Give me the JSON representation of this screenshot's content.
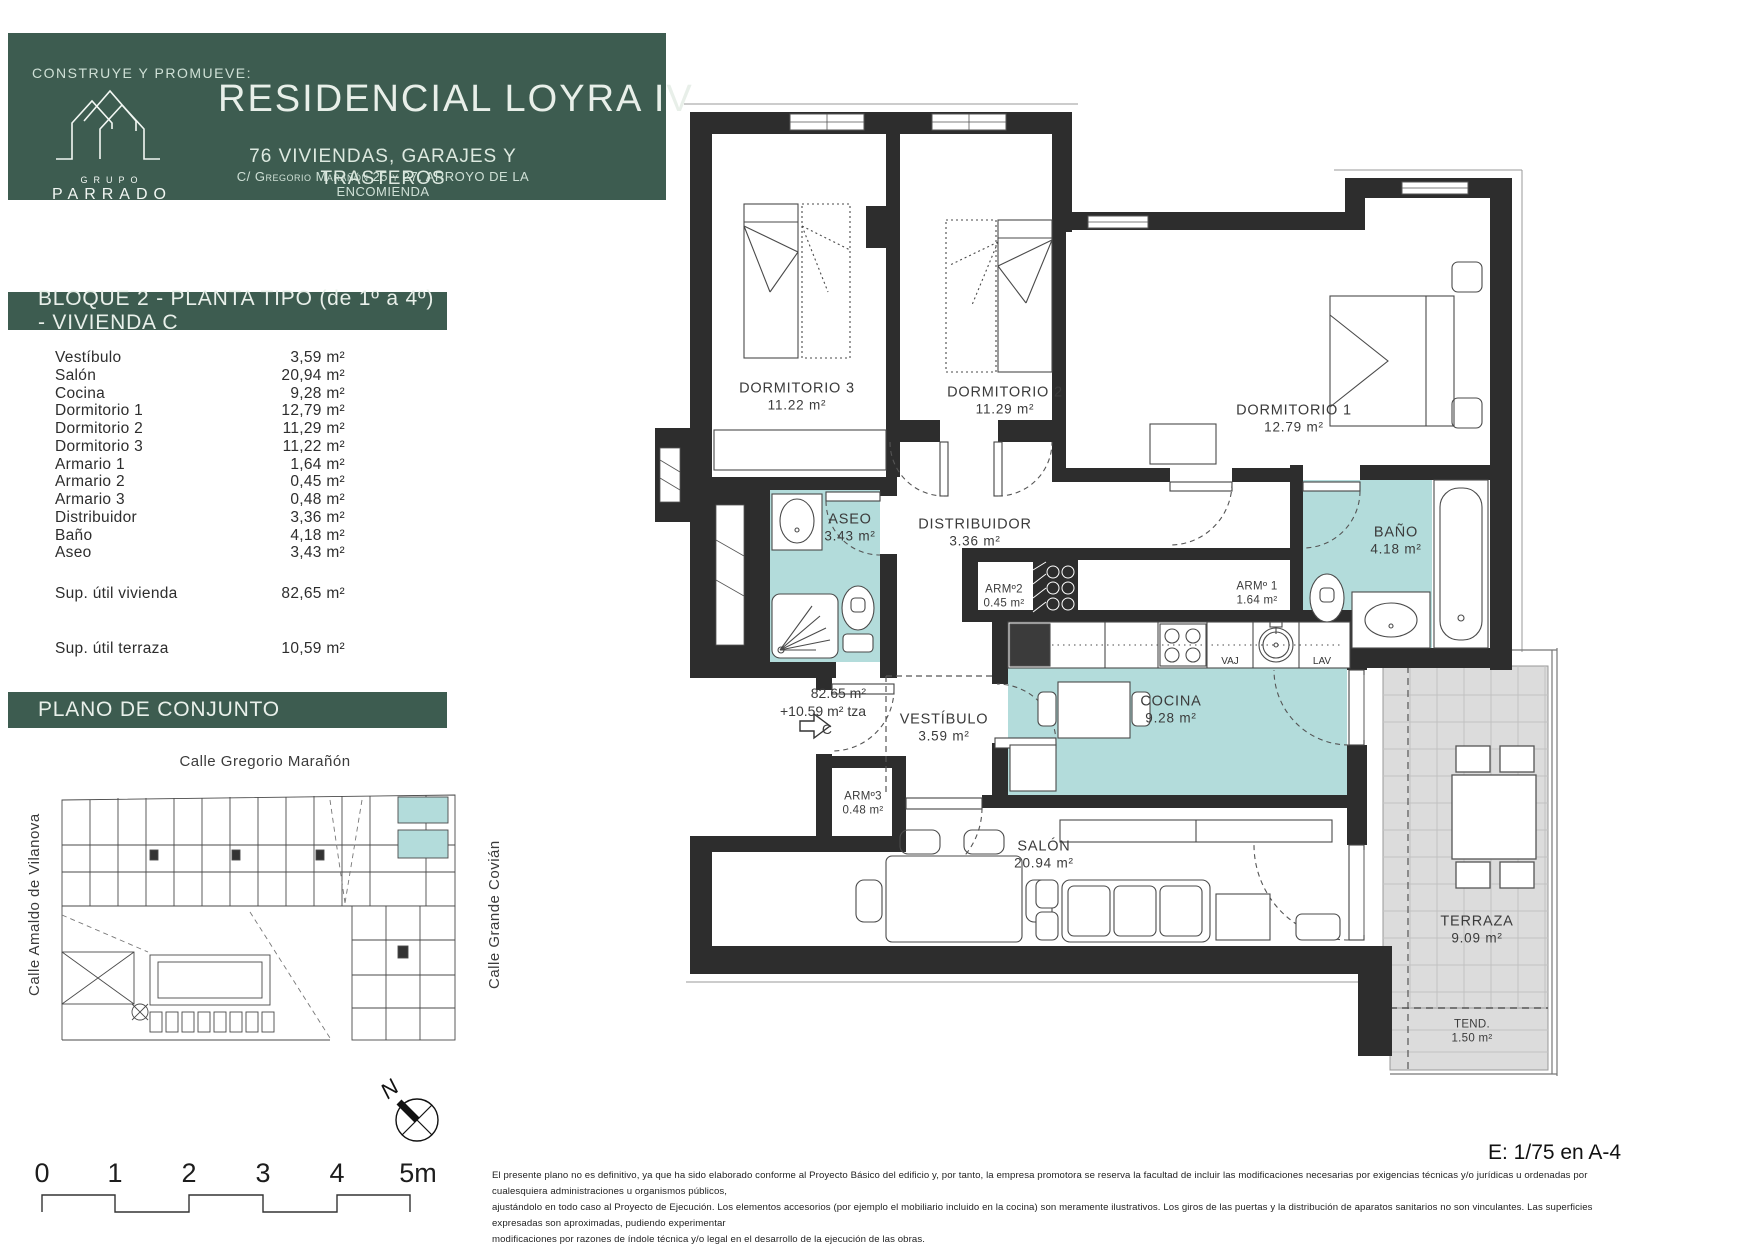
{
  "header": {
    "tagline": "CONSTRUYE Y PROMUEVE:",
    "logo": {
      "top": "GRUPO",
      "bottom": "PARRADO"
    },
    "title": "RESIDENCIAL LOYRA IV",
    "subtitle": "76 VIVIENDAS, GARAJES Y TRASTEROS",
    "address": "C/ Gregorio Marañón 25 y 27. ARROYO DE LA ENCOMIENDA"
  },
  "unit_bar": "BLOQUE 2 - PLANTA TIPO (de 1º a 4º) - VIVIENDA C",
  "areas": {
    "rows": [
      {
        "label": "Vestíbulo",
        "value": "3,59 m²"
      },
      {
        "label": "Salón",
        "value": "20,94 m²"
      },
      {
        "label": "Cocina",
        "value": "9,28 m²"
      },
      {
        "label": "Dormitorio 1",
        "value": "12,79 m²"
      },
      {
        "label": "Dormitorio 2",
        "value": "11,29 m²"
      },
      {
        "label": "Dormitorio 3",
        "value": "11,22 m²"
      },
      {
        "label": "Armario 1",
        "value": "1,64 m²"
      },
      {
        "label": "Armario 2",
        "value": "0,45 m²"
      },
      {
        "label": "Armario 3",
        "value": "0,48 m²"
      },
      {
        "label": "Distribuidor",
        "value": "3,36 m²"
      },
      {
        "label": "Baño",
        "value": "4,18 m²"
      },
      {
        "label": "Aseo",
        "value": "3,43 m²"
      }
    ],
    "totals": [
      {
        "label": "Sup. útil vivienda",
        "value": "82,65 m²"
      },
      {
        "label": "Sup. útil terraza",
        "value": "10,59 m²"
      }
    ]
  },
  "site": {
    "bar": "PLANO DE CONJUNTO",
    "streets": {
      "top": "Calle Gregorio Marañón",
      "left": "Calle Amaldo de Vilanova",
      "right": "Calle Grande Covián"
    }
  },
  "compass": {
    "label": "N"
  },
  "scalebar": {
    "ticks": [
      "0",
      "1",
      "2",
      "3",
      "4",
      "5m"
    ]
  },
  "plan": {
    "rooms": [
      {
        "name": "DORMITORIO 3",
        "area": "11.22 m²"
      },
      {
        "name": "DORMITORIO 2",
        "area": "11.29 m²"
      },
      {
        "name": "DORMITORIO 1",
        "area": "12.79 m²"
      },
      {
        "name": "ASEO",
        "area": "3.43 m²"
      },
      {
        "name": "DISTRIBUIDOR",
        "area": "3.36 m²"
      },
      {
        "name": "BAÑO",
        "area": "4.18 m²"
      },
      {
        "name": "ARMº2",
        "area": "0.45 m²"
      },
      {
        "name": "ARMº 1",
        "area": "1.64 m²"
      },
      {
        "name": "ARMº3",
        "area": "0.48 m²"
      },
      {
        "name": "VESTÍBULO",
        "area": "3.59 m²"
      },
      {
        "name": "COCINA",
        "area": "9.28 m²"
      },
      {
        "name": "SALÓN",
        "area": "20.94 m²"
      },
      {
        "name": "TERRAZA",
        "area": "9.09 m²"
      },
      {
        "name": "TEND.",
        "area": "1.50 m²"
      }
    ],
    "entry_label": {
      "line1": "82.65 m²",
      "line2": "+10.59 m² tza",
      "letter": "C",
      "arrow": "⇨"
    },
    "appliances": {
      "vaj": "VAJ",
      "lav": "LAV"
    }
  },
  "scale_note": "E: 1/75 en A-4",
  "disclaimer": [
    "El presente plano no es definitivo, ya que ha sido elaborado conforme al Proyecto Básico del edificio y, por tanto, la empresa promotora se reserva la facultad de incluir las modificaciones necesarias por exigencias técnicas y/o jurídicas u ordenadas por cualesquiera administraciones u organismos públicos,",
    "ajustándolo en todo caso al Proyecto de Ejecución. Los elementos accesorios (por ejemplo el mobiliario incluido en la cocina) son meramente ilustrativos. Los giros de las puertas y la distribución de aparatos sanitarios no son vinculantes. Las superficies expresadas son aproximadas, pudiendo experimentar",
    "modificaciones por razones de índole técnica y/o legal en el desarrollo de la ejecución de las obras."
  ],
  "colors": {
    "green": "#3D5C50",
    "teal": "#B3DCDB",
    "terrace": "#DCDCDC",
    "wall": "#2D2D2D"
  }
}
